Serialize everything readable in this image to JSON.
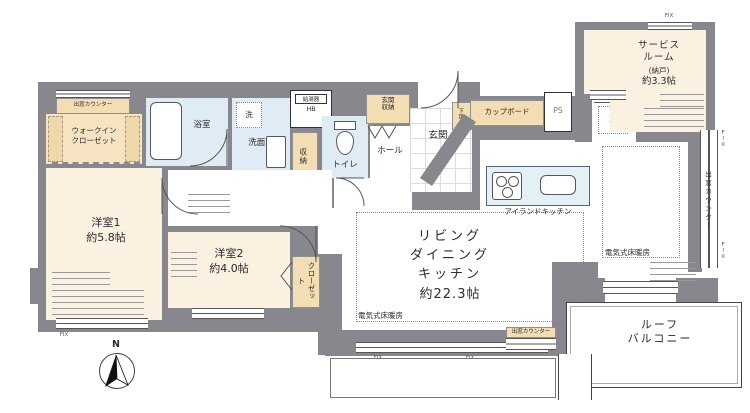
{
  "colors": {
    "wall": "#88878d",
    "room_cream": "#fbf1e1",
    "fixture_beige": "#f3ddb2",
    "water_blue": "#dfecf5",
    "kitchen_blue": "#e3f0f6"
  },
  "labels": {
    "bay_window_counter": "出窓カウンター",
    "walk_in_closet": "ウォークイン\nクローゼット",
    "bathroom": "浴室",
    "washer": "洗",
    "washroom": "洗面室",
    "water_heater": "給湯器",
    "water_heater_sub": "HB",
    "storage": "収納",
    "toilet": "トイレ",
    "entrance_storage": "玄関\n収納",
    "entrance": "玄関",
    "shoe_cabinet": "下足入",
    "hall": "ホール",
    "cupboard": "カップボード",
    "pipe_space": "PS",
    "refrigerator": "冷",
    "service_room_name": "サービス\nルーム",
    "service_room_annex": "(納戸)",
    "service_room_size": "約3.3帖",
    "ldk_name": "リビング\nダイニング\nキッチン",
    "ldk_size": "約22.3帖",
    "island_kitchen": "アイランドキッチン",
    "floor_heating": "電気式床暖房",
    "closet": "クローゼット",
    "room1_name": "洋室1",
    "room1_size": "約5.8帖",
    "room2_name": "洋室2",
    "room2_size": "約4.0帖",
    "roof_balcony": "ルーフ\nバルコニー",
    "fix_window": "FIX",
    "north": "N"
  }
}
